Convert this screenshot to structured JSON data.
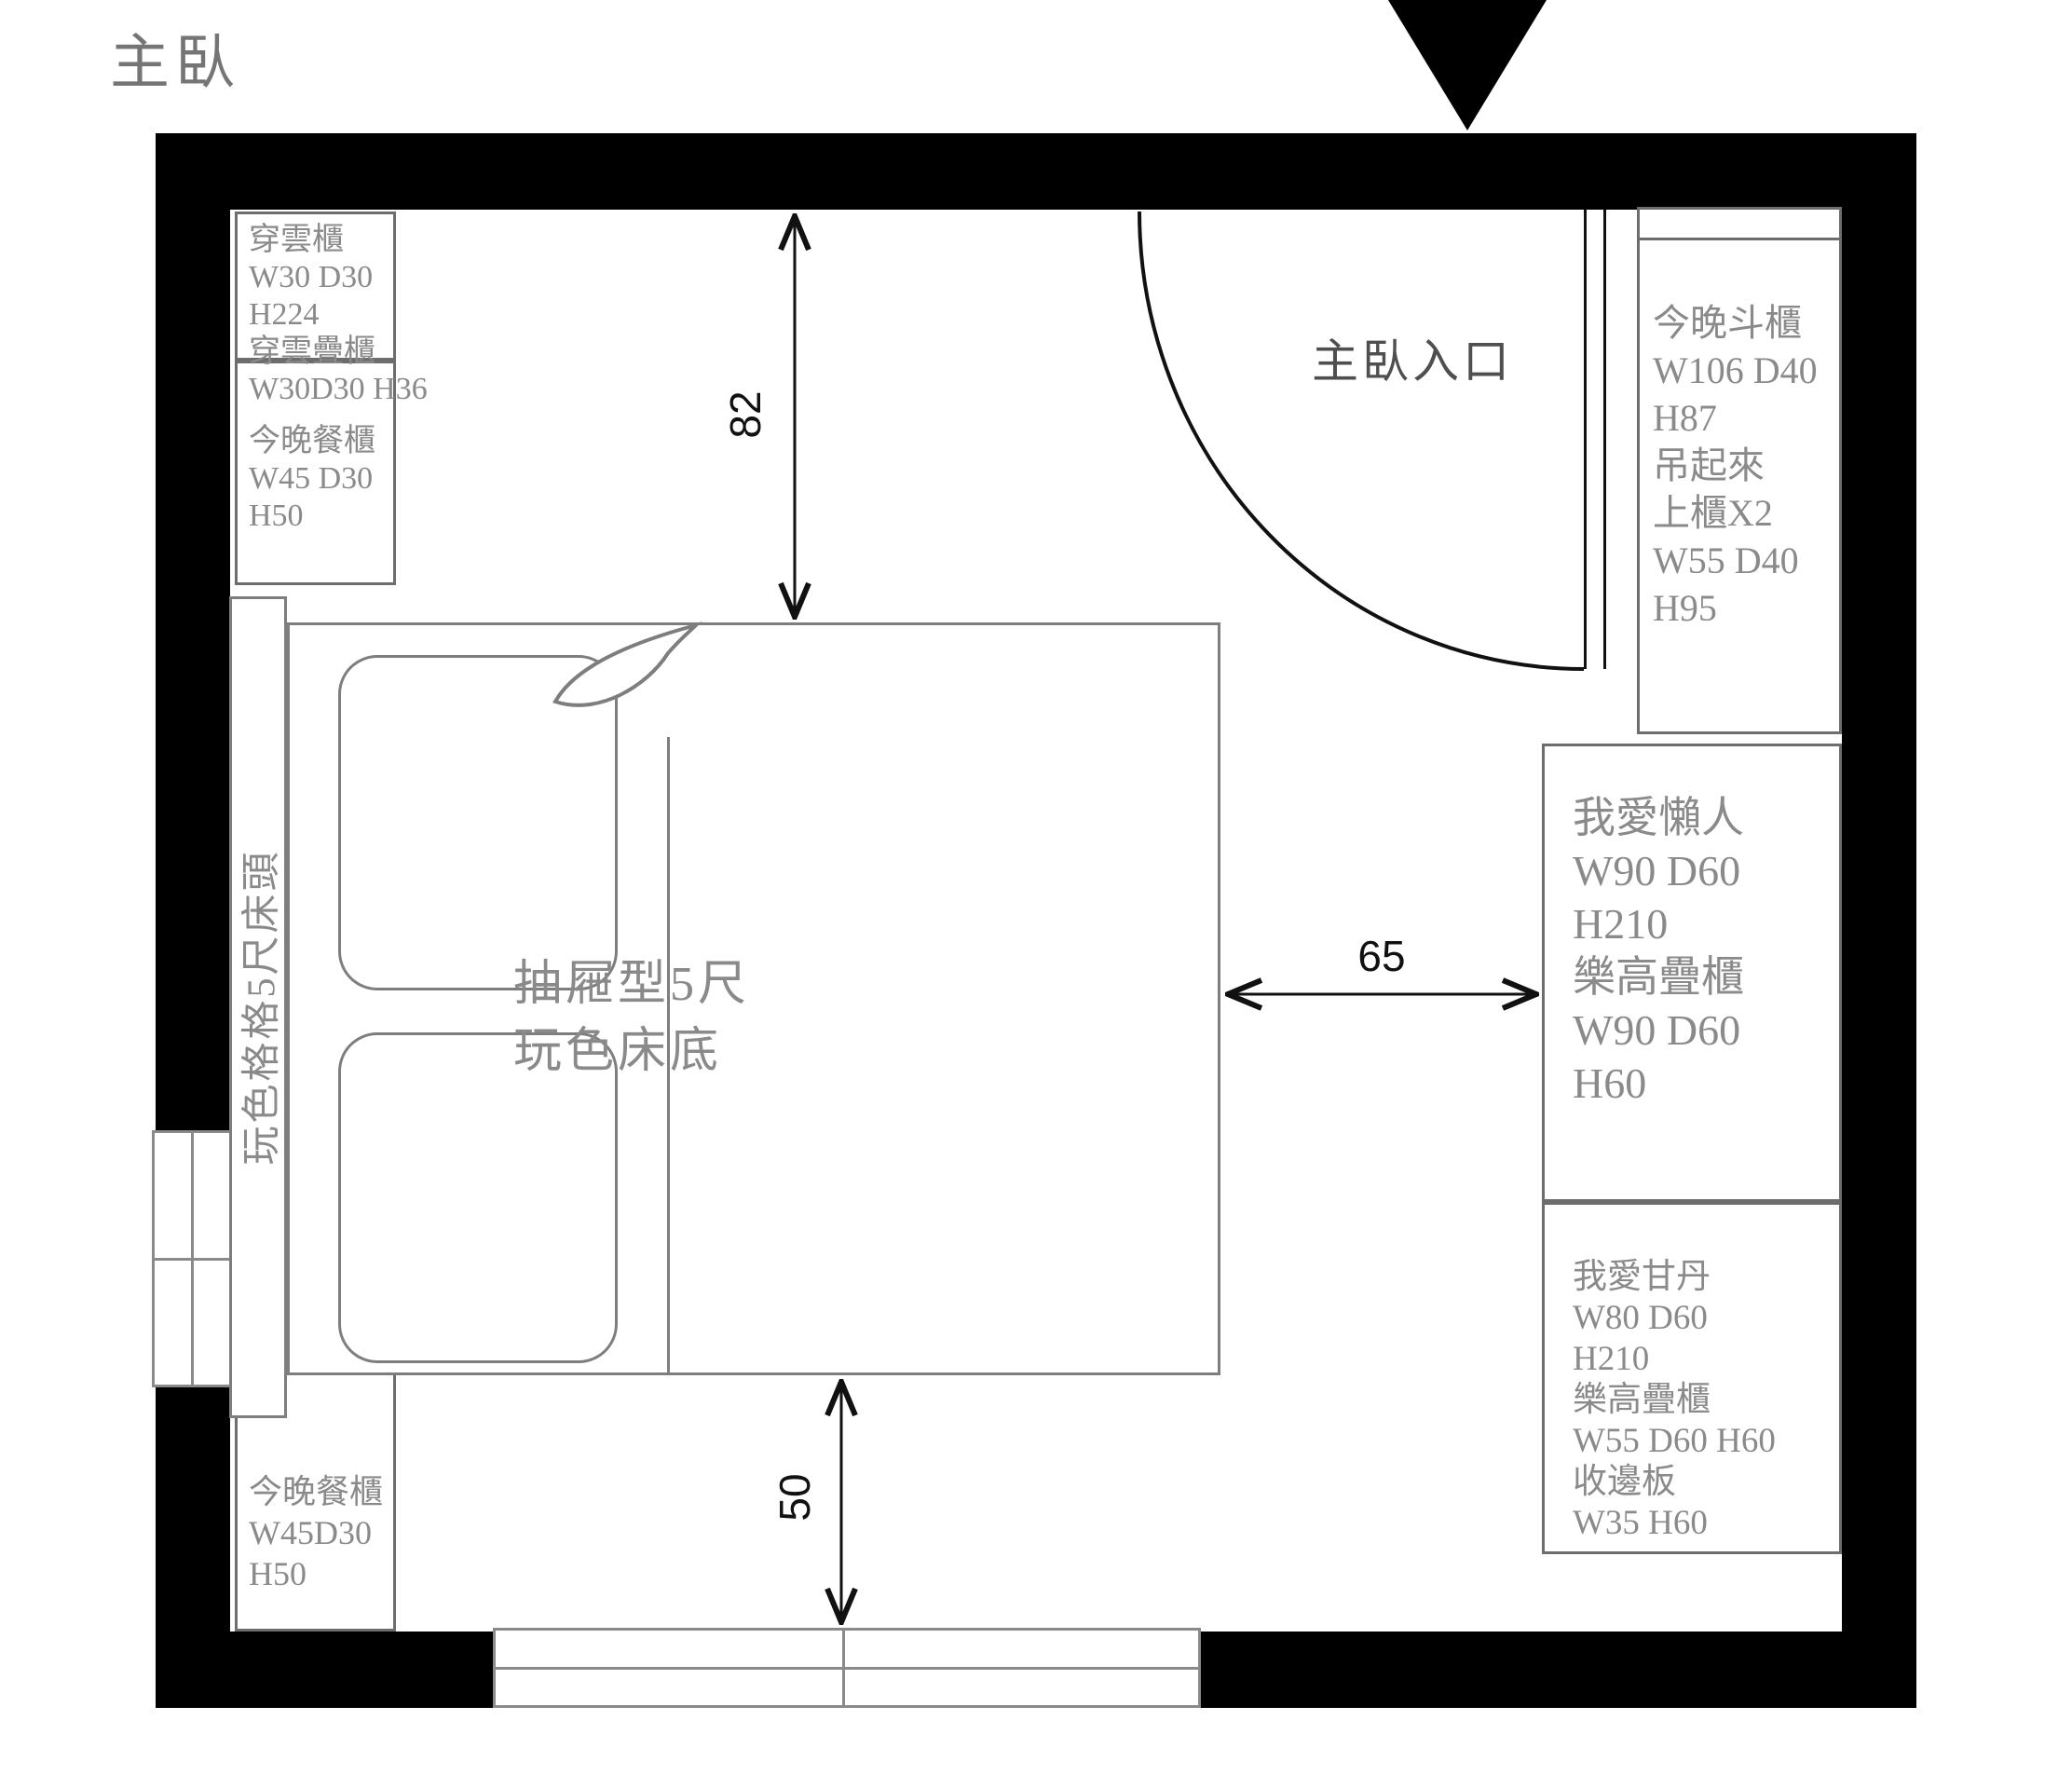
{
  "title": "主臥",
  "entrance": {
    "label": "主臥入口"
  },
  "bed": {
    "label_line1": "抽屜型5尺",
    "label_line2": "玩色床底",
    "headboard_label": "玩色格格5尺床頭"
  },
  "dimensions": {
    "wall_to_bed_top": "82",
    "bed_to_cabinet_right": "65",
    "bed_to_window_bottom": "50"
  },
  "furniture": {
    "chuanyun_cabinet": {
      "lines": [
        "穿雲櫃",
        "W30 D30",
        "H224",
        "穿雲疊櫃",
        "W30D30 H36"
      ]
    },
    "dining_cabinet_top": {
      "lines": [
        "今晚餐櫃",
        "W45 D30",
        "H50"
      ]
    },
    "dou_cabinet": {
      "lines": [
        "今晚斗櫃",
        "W106 D40",
        "H87",
        "吊起來",
        "上櫃X2",
        "W55 D40",
        "H95"
      ]
    },
    "lazy_wardrobe": {
      "lines": [
        "我愛懶人",
        "W90 D60",
        "H210",
        "樂高疊櫃",
        "W90 D60",
        "H60"
      ]
    },
    "gandan_wardrobe": {
      "lines": [
        "我愛甘丹",
        "W80 D60",
        "H210",
        "樂高疊櫃",
        "W55 D60 H60",
        "收邊板",
        "W35  H60"
      ]
    },
    "dining_cabinet_bottom": {
      "lines": [
        "今晚餐櫃",
        "W45D30",
        "H50"
      ]
    }
  },
  "colors": {
    "wall": "#000000",
    "furniture_border": "#6d6d6d",
    "furniture_text": "#8a8a8a",
    "bed_line": "#7e7e7e",
    "dimension_line": "#111111",
    "title_text": "#757575"
  }
}
